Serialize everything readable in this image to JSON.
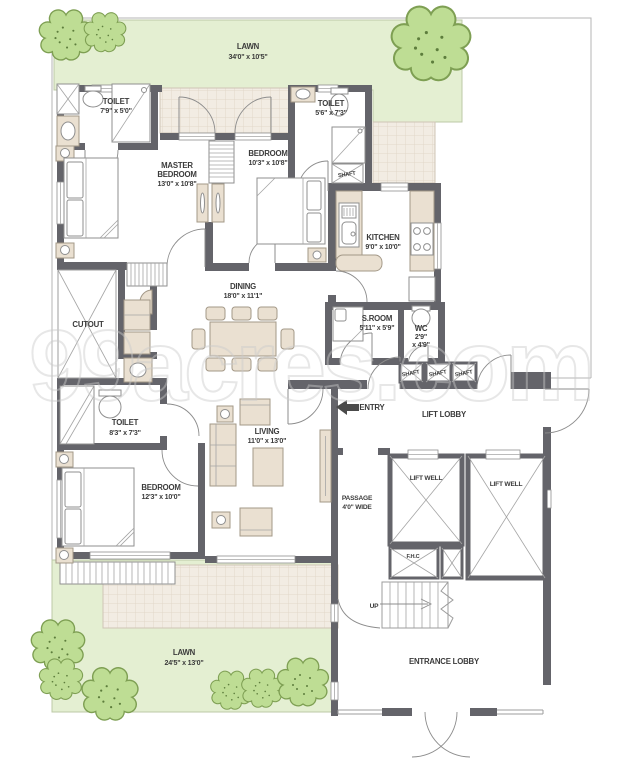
{
  "watermark": "99acres.com",
  "colors": {
    "wall": "#64646a",
    "lawn": "#e4efd2",
    "tile": "#f2ece3",
    "furniture": "#eae0d1",
    "tree": "#bedd94",
    "label_text": "#3b3b3b"
  },
  "rooms": {
    "lawn_top": {
      "name": "LAWN",
      "dims": "34'0\" x 10'5\""
    },
    "toilet_top_left": {
      "name": "TOILET",
      "dims": "7'9\" x 5'0\""
    },
    "master_bedroom": {
      "name_line1": "MASTER",
      "name_line2": "BEDROOM",
      "dims": "13'0\" x 10'8\""
    },
    "bedroom_top": {
      "name": "BEDROOM",
      "dims": "10'3\" x 10'8\""
    },
    "toilet_top_right": {
      "name": "TOILET",
      "dims": "5'6\" x 7'3\""
    },
    "kitchen": {
      "name": "KITCHEN",
      "dims": "9'0\" x 10'0\""
    },
    "dining": {
      "name": "DINING",
      "dims": "18'0\" x 11'1\""
    },
    "cutout": {
      "name": "CUTOUT"
    },
    "s_room": {
      "name": "S.ROOM",
      "dims": "5'11\" x 5'9\""
    },
    "wc": {
      "name": "WC",
      "dims_line1": "2'9\"",
      "dims_line2": "x 4'9\""
    },
    "toilet_mid": {
      "name": "TOILET",
      "dims": "8'3\" x 7'3\""
    },
    "bedroom_bottom": {
      "name": "BEDROOM",
      "dims": "12'3\" x 10'0\""
    },
    "living": {
      "name": "LIVING",
      "dims": "11'0\" x 13'0\""
    },
    "passage": {
      "name_line1": "PASSAGE",
      "name_line2": "4'0\" WIDE"
    },
    "lift_lobby": {
      "name": "LIFT LOBBY"
    },
    "lift_well_left": {
      "name": "LIFT WELL"
    },
    "lift_well_right": {
      "name": "LIFT WELL"
    },
    "fhc": {
      "name": "F.H.C"
    },
    "entrance_lobby": {
      "name": "ENTRANCE LOBBY"
    },
    "lawn_bottom": {
      "name": "LAWN",
      "dims": "24'5\" x 13'0\""
    }
  },
  "annotations": {
    "entry": "ENTRY",
    "up": "UP",
    "shaft_labels": [
      "SHAFT",
      "SHAFT",
      "SHAFT",
      "SHAFT"
    ]
  }
}
